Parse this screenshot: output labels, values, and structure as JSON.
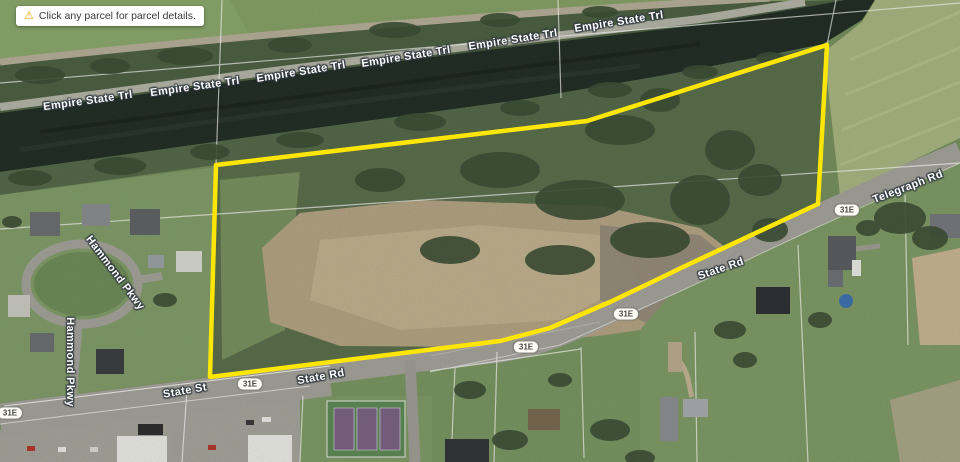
{
  "tooltip": {
    "icon": "warning-icon",
    "icon_glyph": "⚠",
    "text": "Click any parcel for parcel details."
  },
  "parcel": {
    "color": "#FFE606",
    "points": "216,165 587,121 827,45 818,204 683,267 650,283 610,302 550,328 500,341 210,377"
  },
  "road_labels": [
    {
      "text": "Empire State Trl",
      "x": 88,
      "y": 101,
      "rot": -8
    },
    {
      "text": "Empire State Trl",
      "x": 195,
      "y": 87,
      "rot": -8
    },
    {
      "text": "Empire State Trl",
      "x": 301,
      "y": 72,
      "rot": -9
    },
    {
      "text": "Empire State Trl",
      "x": 406,
      "y": 57,
      "rot": -9
    },
    {
      "text": "Empire State Trl",
      "x": 513,
      "y": 40,
      "rot": -9
    },
    {
      "text": "Empire State Trl",
      "x": 619,
      "y": 22,
      "rot": -9
    },
    {
      "text": "Telegraph Rd",
      "x": 908,
      "y": 187,
      "rot": -21
    },
    {
      "text": "State Rd",
      "x": 721,
      "y": 269,
      "rot": -19
    },
    {
      "text": "State Rd",
      "x": 321,
      "y": 377,
      "rot": -10
    },
    {
      "text": "State St",
      "x": 185,
      "y": 391,
      "rot": -10
    },
    {
      "text": "Hammond Pkwy",
      "x": 115,
      "y": 273,
      "rot": 53
    },
    {
      "text": "Hammond Pkwy",
      "x": 70,
      "y": 362,
      "rot": 90
    }
  ],
  "route_shields": [
    {
      "text": "31E",
      "x": 847,
      "y": 210
    },
    {
      "text": "31E",
      "x": 626,
      "y": 314
    },
    {
      "text": "31E",
      "x": 526,
      "y": 347
    },
    {
      "text": "31E",
      "x": 250,
      "y": 384
    },
    {
      "text": "31E",
      "x": 10,
      "y": 413
    }
  ],
  "map_colors": {
    "parcel_outline": "#FFE606",
    "water": "#232f27",
    "road": "#a3a29a",
    "field": "#76905d",
    "dirt": "#b4a383"
  }
}
